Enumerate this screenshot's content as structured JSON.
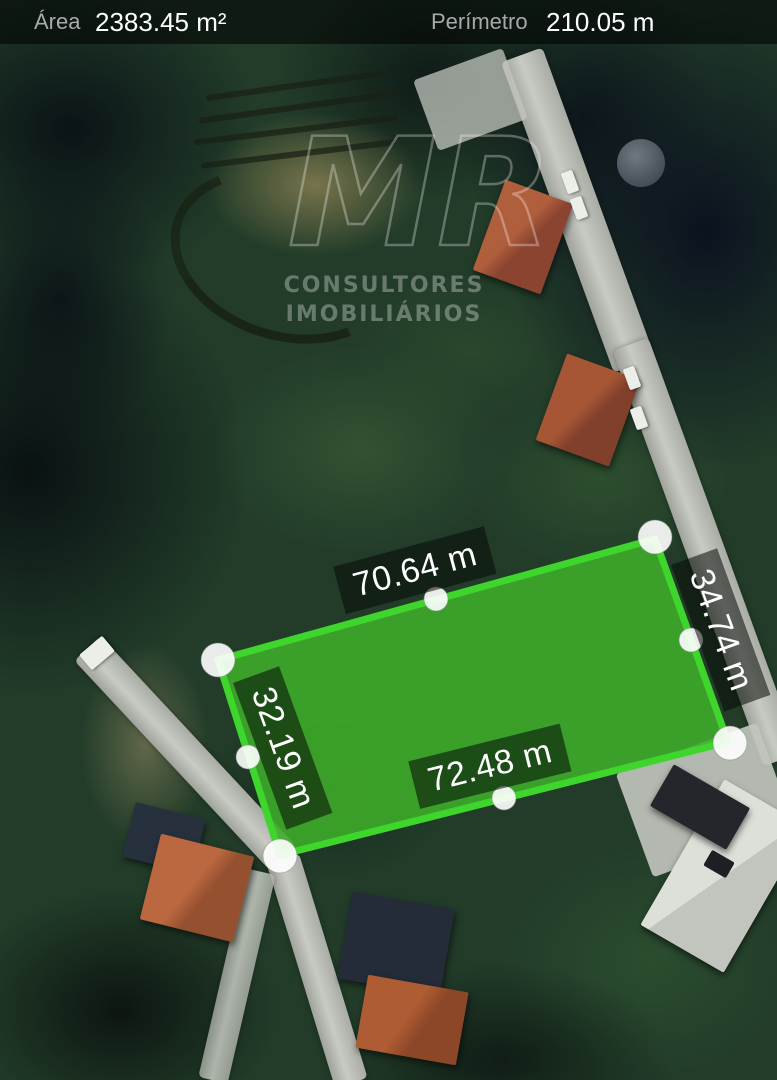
{
  "header": {
    "area_label": "Área",
    "area_value": "2383.45 m²",
    "perimeter_label": "Perímetro",
    "perimeter_value": "210.05 m"
  },
  "measurements": {
    "top_edge": "70.64 m",
    "right_edge": "34.74 m",
    "bottom_edge": "72.48 m",
    "left_edge": "32.19 m"
  },
  "watermark": {
    "logo": "MR",
    "line1": "CONSULTORES",
    "line2": "IMOBILIÁRIOS"
  },
  "colors": {
    "polygon_fill": "#3fae2a",
    "polygon_stroke": "#3ed62c",
    "handle_color": "#ffffff",
    "label_bg": "rgba(5,10,5,0.55)",
    "header_bg": "rgba(0,0,0,0.54)"
  }
}
